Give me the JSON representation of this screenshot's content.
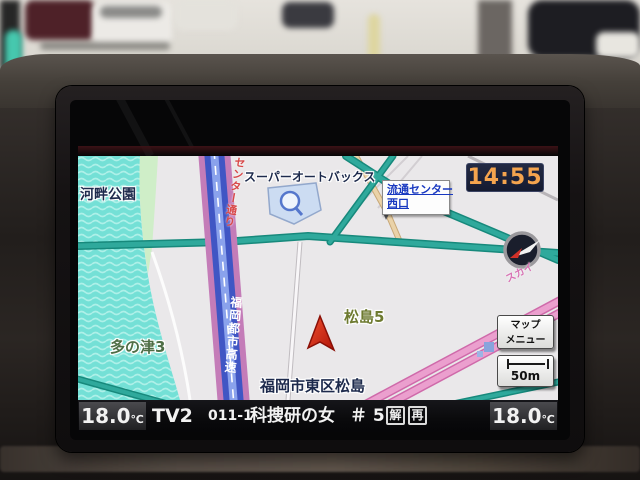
{
  "clock": {
    "time": "14:55"
  },
  "map": {
    "poi_park": "河畔公園",
    "poi_autobacs": "スーパーオートバックス",
    "signboard_line1": "流通センター",
    "signboard_line2": "西口",
    "district_matsushima": "松島5",
    "district_tanotsu": "多の津3",
    "current_address": "福岡市東区松島",
    "road_expressway": "福岡都市高速",
    "road_center_dori": "センター通り",
    "road_pink_label": "スカイ",
    "map_menu_line1": "マップ",
    "map_menu_line2": "メニュー",
    "scale_label": "50m"
  },
  "status_bar": {
    "temp_left_value": "18.0",
    "temp_left_unit": "℃",
    "source": "TV2",
    "channel": "011-1",
    "program_title": "科捜研の女",
    "episode": "＃ 5",
    "badge_commentary": "解",
    "badge_rerun": "再",
    "temp_right_value": "18.0",
    "temp_right_unit": "℃"
  },
  "colors": {
    "clock_text": "#f4a44e",
    "water": "#74e0d6",
    "road_teal": "#2fa99c",
    "road_pink": "#eb9fce",
    "highway_blue": "#4056c4",
    "highway_pink_casing": "#c47cb8",
    "position_arrow": "#d42a1a",
    "signboard_text": "#1838c0"
  }
}
